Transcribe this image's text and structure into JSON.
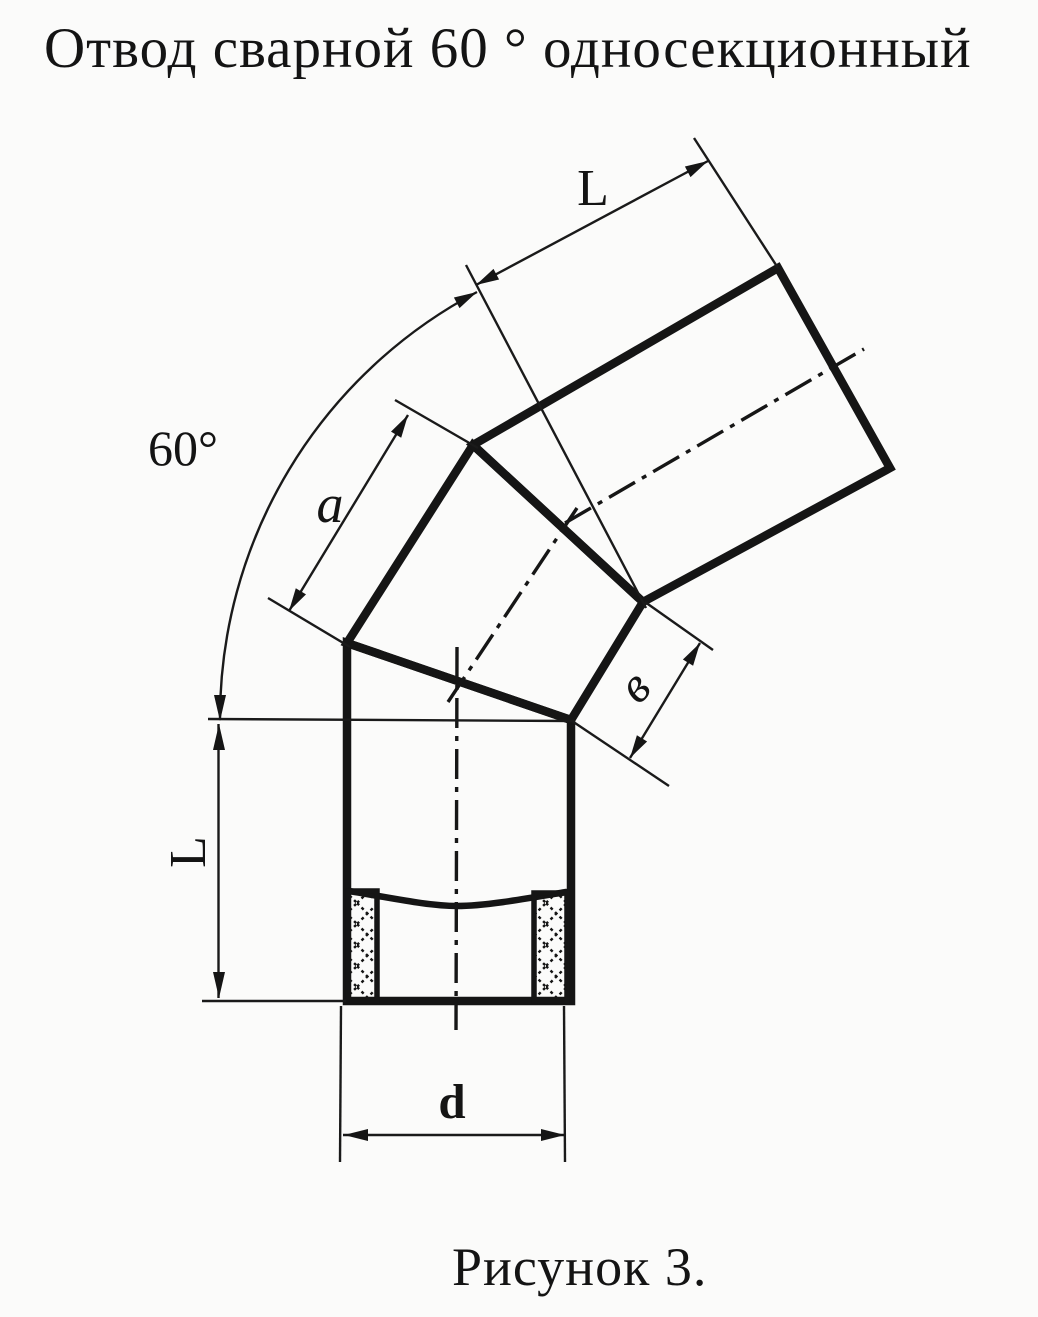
{
  "figure": {
    "title": "Отвод сварной 60 ° односекционный",
    "caption": "Рисунок 3."
  },
  "dimensions": {
    "upper_segment_length": "L",
    "bend_angle": "60°",
    "section_side": "a",
    "section_end_width": "в",
    "lower_segment_length": "L",
    "pipe_diameter": "d"
  },
  "colors": {
    "ink": "#151515",
    "paper": "#fbfbfa"
  }
}
